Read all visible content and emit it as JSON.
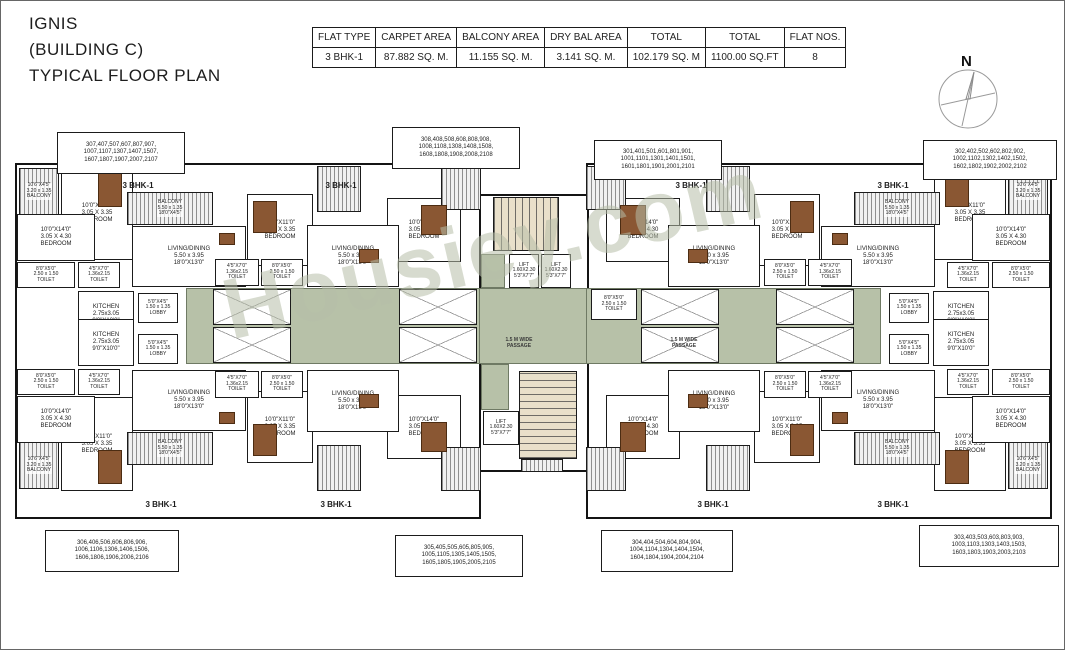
{
  "title": {
    "line1": "IGNIS",
    "line2": "(BUILDING C)",
    "line3": "TYPICAL FLOOR PLAN"
  },
  "compass": {
    "label": "N"
  },
  "watermark": "Housiey.com",
  "summary_table": {
    "headers": [
      "FLAT TYPE",
      "CARPET AREA",
      "BALCONY AREA",
      "DRY BAL AREA",
      "TOTAL",
      "TOTAL",
      "FLAT NOS."
    ],
    "row": [
      "3 BHK-1",
      "87.882 SQ. M.",
      "11.155 SQ. M.",
      "3.141 SQ. M.",
      "102.179 SQ. M",
      "1100.00 SQ.FT",
      "8"
    ]
  },
  "unit_type_label": "3 BHK-1",
  "passage_label": "1.5 M WIDE PASSAGE",
  "flat_number_groups": [
    {
      "position": "top-left",
      "lines": [
        "307,407,507,607,807,907,",
        "1007,1107,1307,1407,1507,",
        "1607,1807,1907,2007,2107"
      ]
    },
    {
      "position": "top-center-left",
      "lines": [
        "308,408,508,608,808,908,",
        "1008,1108,1308,1408,1508,",
        "1608,1808,1908,2008,2108"
      ]
    },
    {
      "position": "top-center-right",
      "lines": [
        "301,401,501,601,801,901,",
        "1001,1101,1301,1401,1501,",
        "1601,1801,1901,2001,2101"
      ]
    },
    {
      "position": "top-right",
      "lines": [
        "302,402,502,602,802,902,",
        "1002,1102,1302,1402,1502,",
        "1602,1802,1902,2002,2102"
      ]
    },
    {
      "position": "bottom-left",
      "lines": [
        "306,406,506,606,806,906,",
        "1006,1106,1306,1406,1506,",
        "1606,1806,1906,2006,2106"
      ]
    },
    {
      "position": "bottom-center-left",
      "lines": [
        "305,405,505,605,805,905,",
        "1005,1105,1305,1405,1505,",
        "1605,1805,1905,2005,2105"
      ]
    },
    {
      "position": "bottom-center-right",
      "lines": [
        "304,404,504,604,804,904,",
        "1004,1104,1304,1404,1504,",
        "1604,1804,1904,2004,2104"
      ]
    },
    {
      "position": "bottom-right",
      "lines": [
        "303,403,503,603,803,903,",
        "1003,1103,1303,1403,1503,",
        "1603,1803,1903,2003,2103"
      ]
    }
  ],
  "room_labels": {
    "bedroom_11": [
      "10'0\"X11'0\"",
      "3.05 X 3.35",
      "BEDROOM"
    ],
    "bedroom_14": [
      "10'0\"X14'0\"",
      "3.05 X 4.30",
      "BEDROOM"
    ],
    "living_dining": [
      "LIVING/DINING",
      "5.50 x 3.95",
      "18'0\"X13'0\""
    ],
    "kitchen": [
      "KITCHEN",
      "2.75x3.05",
      "9'0\"X10'0\""
    ],
    "toilet_large": [
      "8'0\"X5'0\"",
      "2.50 x 1.50",
      "TOILET"
    ],
    "toilet_small": [
      "4'5\"X7'0\"",
      "1.36x2.15",
      "TOILET"
    ],
    "balcony_wide": [
      "BALCONY",
      "5.50 x 1.35",
      "18'0\"X4'5\""
    ],
    "balcony_small": [
      "10'6\"X4'5\"",
      "3.20 x 1.35",
      "BALCONY"
    ],
    "lobby": [
      "5'0\"X4'5\"",
      "1.50 x 1.35",
      "LOBBY"
    ],
    "lift": [
      "LIFT",
      "1.60X2.30",
      "5'3\"X7'7\""
    ]
  },
  "colors": {
    "corridor_green": "#b7c1a8",
    "stair_beige": "#e9e0ca",
    "furniture_brown": "#8a5733",
    "wall_black": "#141414"
  }
}
